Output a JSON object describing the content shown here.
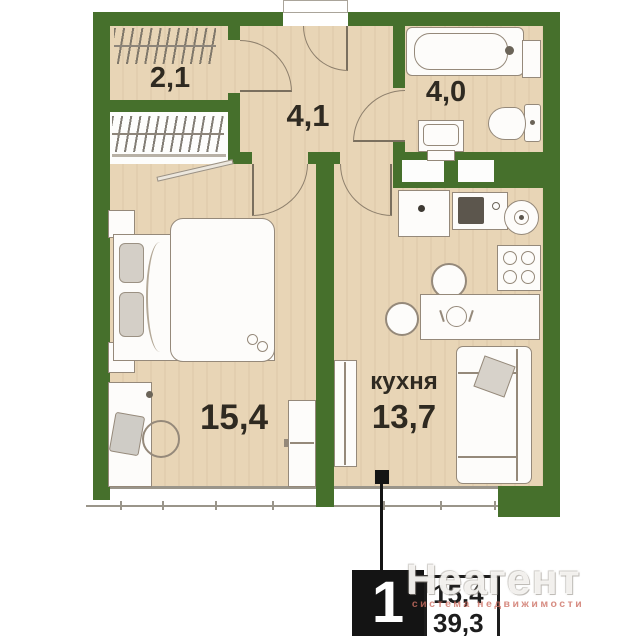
{
  "floorplan": {
    "rooms": {
      "wardrobe": {
        "area": "2,1"
      },
      "hallway": {
        "area": "4,1"
      },
      "bathroom": {
        "area": "4,0"
      },
      "bedroom": {
        "area": "15,4"
      },
      "kitchen": {
        "name": "кухня",
        "area": "13,7"
      }
    },
    "colors": {
      "wall": "#46702c",
      "floor": "#e8d5b6",
      "callout_black": "#141414",
      "watermark_red": "#cd7064"
    }
  },
  "callout": {
    "rooms_count": "1",
    "living_area": "15,4",
    "total_area": "39,3"
  },
  "watermark": {
    "title": "Неагент",
    "subtitle": "система недвижимости"
  }
}
